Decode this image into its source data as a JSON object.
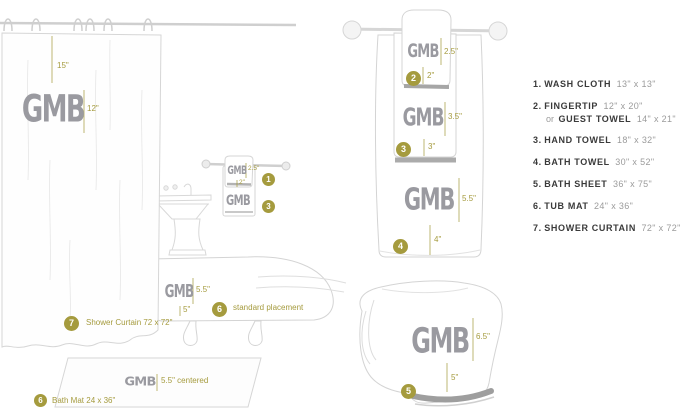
{
  "monogram": "GMB",
  "colors": {
    "accent": "#a59b3e",
    "monogram_gray": "#9a9aa0",
    "legend_text": "#3a3a3a",
    "size_text": "#9b9b9b",
    "line_art": "#d4d4d4"
  },
  "legend": {
    "items": [
      {
        "num": "1.",
        "name": "WASH CLOTH",
        "size": "13\" x 13\""
      },
      {
        "num": "2.",
        "name": "FINGERTIP",
        "size": "12\" x 20\"",
        "or": "or",
        "alt_name": "GUEST TOWEL",
        "alt_size": "14\" x 21\""
      },
      {
        "num": "3.",
        "name": "HAND TOWEL",
        "size": "18\" x 32\""
      },
      {
        "num": "4.",
        "name": "BATH TOWEL",
        "size": "30\" x 52\""
      },
      {
        "num": "5.",
        "name": "BATH SHEET",
        "size": "36\" x 75\""
      },
      {
        "num": "6.",
        "name": "TUB MAT",
        "size": "24\" x 36\""
      },
      {
        "num": "7.",
        "name": "SHOWER CURTAIN",
        "size": "72\" x 72\""
      }
    ]
  },
  "scene": {
    "shower_curtain": {
      "drop_measure": "15\"",
      "side_measure": "12\"",
      "badge": "7",
      "label": "Shower Curtain 72 x 72\""
    },
    "wall_washcloth": {
      "badge": "1",
      "side_measure": "2.5\"",
      "bottom_measure": "2\""
    },
    "wall_hand_towel": {
      "badge": "3"
    },
    "tub_mat": {
      "badge": "6",
      "side_measure": "5.5\"",
      "bottom_measure": "5\"",
      "label": "standard placement"
    },
    "bath_mat": {
      "badge": "6",
      "measure": "5.5\" centered",
      "label": "Bath Mat 24 x 36\""
    },
    "fingertip": {
      "badge": "2",
      "side_measure": "2.5\"",
      "bottom_measure": "2\""
    },
    "hand_towel": {
      "badge": "3",
      "side_measure": "3.5\"",
      "bottom_measure": "3\""
    },
    "bath_towel": {
      "badge": "4",
      "side_measure": "5.5\"",
      "bottom_measure": "4\""
    },
    "bath_sheet": {
      "badge": "5",
      "side_measure": "6.5\"",
      "bottom_measure": "5\""
    }
  }
}
